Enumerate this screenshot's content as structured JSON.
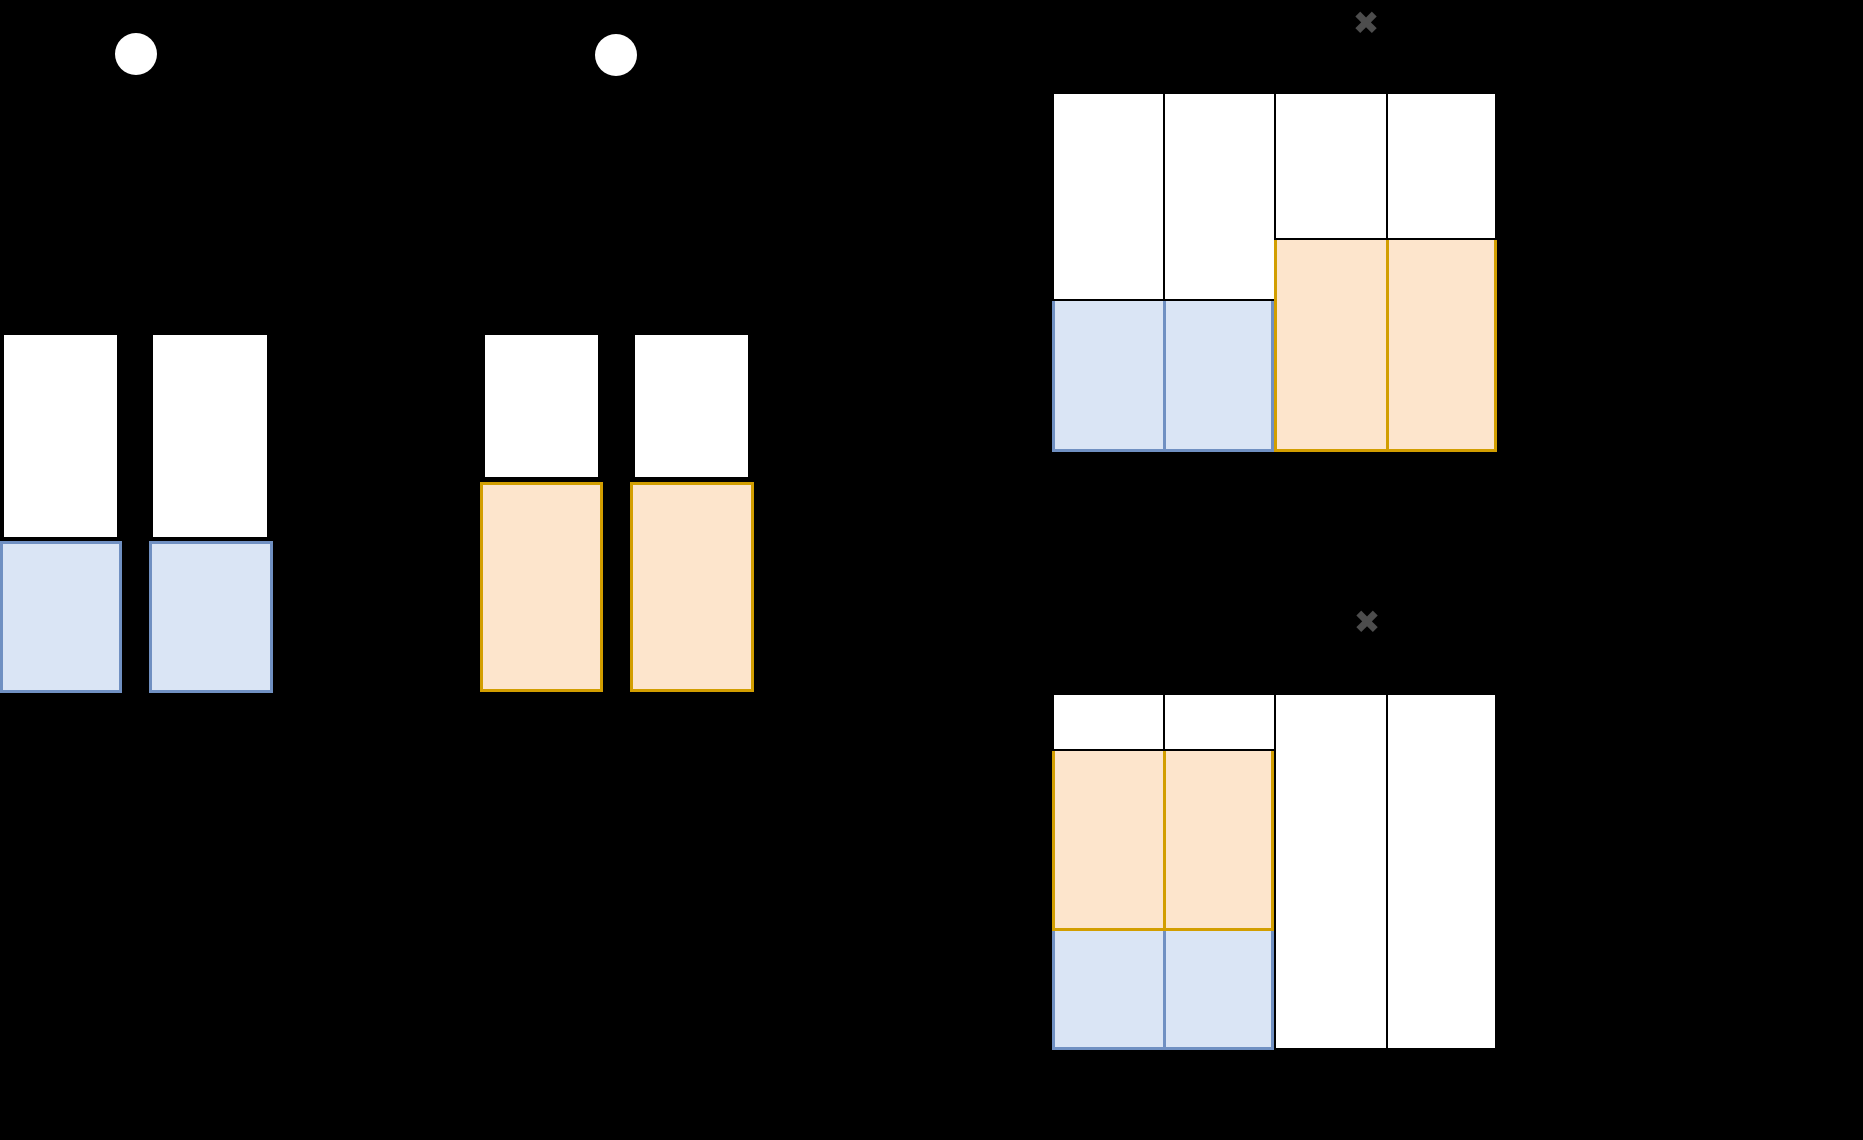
{
  "figure": {
    "width": 1863,
    "height": 1140,
    "background": "#000000",
    "palette": {
      "white": "#FFFFFF",
      "black": "#000000",
      "blue_fill": "#DAE5F5",
      "blue_stroke": "#7090C2",
      "orange_fill": "#FDE5CC",
      "orange_stroke": "#D29E00",
      "x_gray": "#4D4D4D"
    },
    "stroke_widths": {
      "black": 2,
      "blue_stroke": 3,
      "orange_stroke": 3
    },
    "dots": [
      {
        "name": "bullet-dot-1",
        "cx": 136,
        "cy": 54,
        "r": 21
      },
      {
        "name": "bullet-dot-2",
        "cx": 616,
        "cy": 55,
        "r": 21
      }
    ],
    "multiply_signs": {
      "glyph": "✖",
      "items": [
        {
          "name": "multiply-icon-1",
          "cx": 1366,
          "cy": 23
        },
        {
          "name": "multiply-icon-2",
          "cx": 1367,
          "cy": 622
        }
      ]
    },
    "rects": [
      {
        "name": "group1-bar1-unshaded",
        "x": 2,
        "y": 333,
        "w": 117,
        "h": 206,
        "fill": "white",
        "stroke": "black"
      },
      {
        "name": "group1-bar1-blue",
        "x": 0,
        "y": 541,
        "w": 122,
        "h": 152,
        "fill": "blue_fill",
        "stroke": "blue_stroke"
      },
      {
        "name": "group1-bar2-unshaded",
        "x": 151,
        "y": 333,
        "w": 118,
        "h": 206,
        "fill": "white",
        "stroke": "black"
      },
      {
        "name": "group1-bar2-blue",
        "x": 149,
        "y": 541,
        "w": 124,
        "h": 152,
        "fill": "blue_fill",
        "stroke": "blue_stroke"
      },
      {
        "name": "group2-bar1-unshaded",
        "x": 483,
        "y": 333,
        "w": 117,
        "h": 146,
        "fill": "white",
        "stroke": "black"
      },
      {
        "name": "group2-bar1-orange",
        "x": 480,
        "y": 482,
        "w": 123,
        "h": 210,
        "fill": "orange_fill",
        "stroke": "orange_stroke"
      },
      {
        "name": "group2-bar2-unshaded",
        "x": 633,
        "y": 333,
        "w": 117,
        "h": 146,
        "fill": "white",
        "stroke": "black"
      },
      {
        "name": "group2-bar2-orange",
        "x": 630,
        "y": 482,
        "w": 124,
        "h": 210,
        "fill": "orange_fill",
        "stroke": "orange_stroke"
      },
      {
        "name": "grid1-col1-unshaded",
        "x": 1052,
        "y": 92,
        "w": 113,
        "h": 209,
        "fill": "white",
        "stroke": "black"
      },
      {
        "name": "grid1-col2-unshaded",
        "x": 1163,
        "y": 92,
        "w": 113,
        "h": 209,
        "fill": "white",
        "stroke": "black"
      },
      {
        "name": "grid1-col3-unshaded",
        "x": 1274,
        "y": 92,
        "w": 114,
        "h": 148,
        "fill": "white",
        "stroke": "black"
      },
      {
        "name": "grid1-col4-unshaded",
        "x": 1386,
        "y": 92,
        "w": 111,
        "h": 148,
        "fill": "white",
        "stroke": "black"
      },
      {
        "name": "grid1-col1-blue",
        "x": 1052,
        "y": 301,
        "w": 114,
        "h": 151,
        "fill": "blue_fill",
        "stroke": "blue_stroke",
        "noTop": true
      },
      {
        "name": "grid1-col2-blue",
        "x": 1163,
        "y": 301,
        "w": 111,
        "h": 151,
        "fill": "blue_fill",
        "stroke": "blue_stroke",
        "noTop": true
      },
      {
        "name": "grid1-col3-orange",
        "x": 1274,
        "y": 240,
        "w": 115,
        "h": 212,
        "fill": "orange_fill",
        "stroke": "orange_stroke",
        "noTop": true
      },
      {
        "name": "grid1-col4-orange",
        "x": 1386,
        "y": 240,
        "w": 111,
        "h": 212,
        "fill": "orange_fill",
        "stroke": "orange_stroke",
        "noTop": true
      },
      {
        "name": "grid2-col1-unshaded",
        "x": 1052,
        "y": 693,
        "w": 113,
        "h": 58,
        "fill": "white",
        "stroke": "black"
      },
      {
        "name": "grid2-col2-unshaded",
        "x": 1163,
        "y": 693,
        "w": 113,
        "h": 58,
        "fill": "white",
        "stroke": "black"
      },
      {
        "name": "grid2-col3-unshaded",
        "x": 1274,
        "y": 693,
        "w": 114,
        "h": 357,
        "fill": "white",
        "stroke": "black"
      },
      {
        "name": "grid2-col4-unshaded",
        "x": 1386,
        "y": 693,
        "w": 111,
        "h": 357,
        "fill": "white",
        "stroke": "black"
      },
      {
        "name": "grid2-col1-orange",
        "x": 1052,
        "y": 751,
        "w": 114,
        "h": 180,
        "fill": "orange_fill",
        "stroke": "orange_stroke",
        "noTop": true
      },
      {
        "name": "grid2-col2-orange",
        "x": 1163,
        "y": 751,
        "w": 111,
        "h": 180,
        "fill": "orange_fill",
        "stroke": "orange_stroke",
        "noTop": true
      },
      {
        "name": "grid2-col1-blue",
        "x": 1052,
        "y": 931,
        "w": 114,
        "h": 119,
        "fill": "blue_fill",
        "stroke": "blue_stroke",
        "noTop": true
      },
      {
        "name": "grid2-col2-blue",
        "x": 1163,
        "y": 931,
        "w": 111,
        "h": 119,
        "fill": "blue_fill",
        "stroke": "blue_stroke",
        "noTop": true
      }
    ]
  }
}
